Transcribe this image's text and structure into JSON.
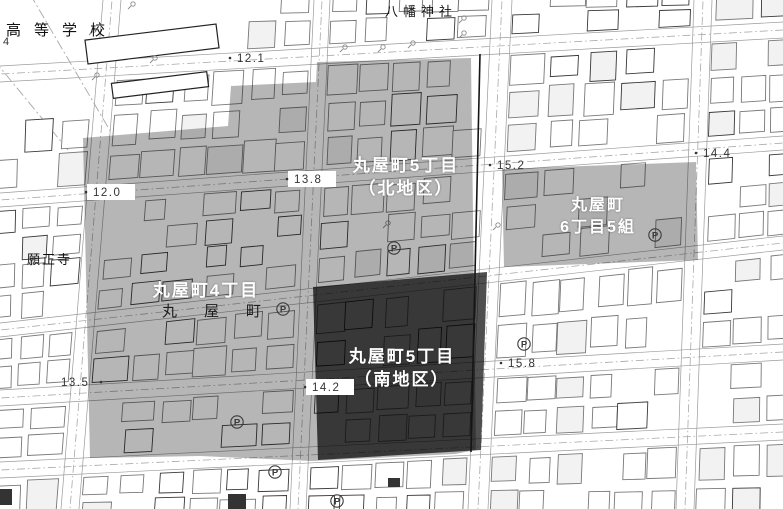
{
  "map": {
    "landmarks": {
      "school": "高等学校",
      "shrine": "八幡神社",
      "temple": "願正寺",
      "street_name": "丸屋町",
      "corner_number": "4"
    },
    "districts": [
      {
        "id": "maruyacho-5-kita",
        "line1": "丸屋町5丁目",
        "line2": "（北地区）",
        "shade": "light"
      },
      {
        "id": "maruyacho-6-5",
        "line1": "丸屋町",
        "line2": "6丁目5組",
        "shade": "light"
      },
      {
        "id": "maruyacho-4",
        "line1": "丸屋町4丁目",
        "line2": "",
        "shade": "light"
      },
      {
        "id": "maruyacho-5-minami",
        "line1": "丸屋町5丁目",
        "line2": "（南地区）",
        "shade": "dark"
      }
    ],
    "spot_elevations": [
      {
        "value": "12.1",
        "x": 237,
        "y": 62,
        "dot": "left",
        "boxed": false
      },
      {
        "value": "12.0",
        "x": 93,
        "y": 196,
        "dot": "left",
        "boxed": true
      },
      {
        "value": "13.8",
        "x": 294,
        "y": 183,
        "dot": "left",
        "boxed": true
      },
      {
        "value": "15.2",
        "x": 497,
        "y": 169,
        "dot": "left",
        "boxed": false
      },
      {
        "value": "14.4",
        "x": 703,
        "y": 157,
        "dot": "left",
        "boxed": false
      },
      {
        "value": "13.5",
        "x": 61,
        "y": 386,
        "dot": "right",
        "boxed": false
      },
      {
        "value": "14.2",
        "x": 312,
        "y": 391,
        "dot": "left",
        "boxed": true
      },
      {
        "value": "15.8",
        "x": 508,
        "y": 367,
        "dot": "left",
        "boxed": false
      }
    ],
    "parking_icons": [
      {
        "x": 283,
        "y": 309
      },
      {
        "x": 394,
        "y": 248
      },
      {
        "x": 655,
        "y": 235
      },
      {
        "x": 524,
        "y": 344
      },
      {
        "x": 237,
        "y": 422
      },
      {
        "x": 275,
        "y": 472
      },
      {
        "x": 337,
        "y": 501
      }
    ],
    "pole_icons": [
      {
        "x": 133,
        "y": 4
      },
      {
        "x": 94,
        "y": 30
      },
      {
        "x": 97,
        "y": 75
      },
      {
        "x": 155,
        "y": 58
      },
      {
        "x": 345,
        "y": 47
      },
      {
        "x": 383,
        "y": 47
      },
      {
        "x": 413,
        "y": 43
      },
      {
        "x": 464,
        "y": 18
      },
      {
        "x": 464,
        "y": 33
      },
      {
        "x": 388,
        "y": 223
      },
      {
        "x": 498,
        "y": 225
      }
    ],
    "colors": {
      "region_light": "rgba(0,0,0,0.285)",
      "region_dark": "rgba(0,0,0,0.69)",
      "building_outline": "#787878",
      "building_outline_dark": "#383838",
      "boundary_line": "#a8a8a8",
      "curb_line": "#9a9a9a",
      "heavy_line": "#151515",
      "label_white": "#ffffff",
      "map_text": "#111111",
      "elevation_text": "#333333"
    }
  }
}
